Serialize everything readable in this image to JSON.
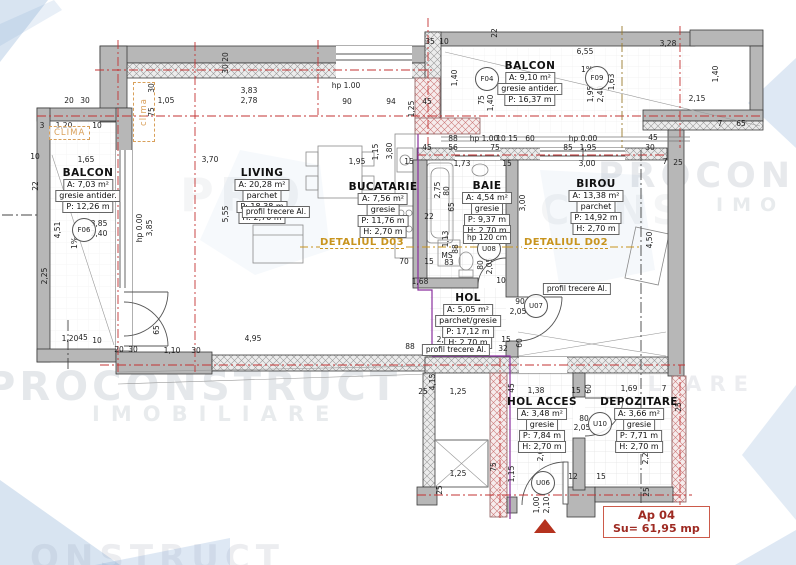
{
  "meta": {
    "apartment": "Ap 04",
    "surface": "Su= 61,95 mp"
  },
  "colors": {
    "axis_red": "#c33333",
    "detail_orange": "#c8941e",
    "boundary_purple": "#8a2f9e",
    "entrance_red": "#b5321e",
    "wall_gray": "#b7b7b7",
    "watermark": "rgba(95,110,130,0.16)"
  },
  "rooms": {
    "balcon_left": {
      "name": "BALCON",
      "area": "A: 7,03 m²",
      "finish": "gresie antider.",
      "perimeter": "P: 12,26 m"
    },
    "balcon_top": {
      "name": "BALCON",
      "area": "A: 9,10 m²",
      "finish": "gresie antider.",
      "perimeter": "P: 16,37 m"
    },
    "living": {
      "name": "LIVING",
      "area": "A: 20,28 m²",
      "finish": "parchet",
      "perimeter": "P: 18,38 m",
      "height": "H: 2,70 m"
    },
    "bucatarie": {
      "name": "BUCATARIE",
      "area": "A: 7,56 m²",
      "finish": "gresie",
      "perimeter": "P: 11,76 m",
      "height": "H: 2,70 m"
    },
    "baie": {
      "name": "BAIE",
      "area": "A: 4,54 m²",
      "finish": "gresie",
      "perimeter": "P: 9,37 m",
      "height": "H: 2,70 m",
      "note": "hp 120 cm"
    },
    "birou": {
      "name": "BIROU",
      "area": "A: 13,38 m²",
      "finish": "parchet",
      "perimeter": "P: 14,92 m",
      "height": "H: 2,70 m"
    },
    "hol": {
      "name": "HOL",
      "area": "A: 5,05 m²",
      "finish": "parchet/gresie",
      "perimeter": "P: 17,12 m",
      "height": "H: 2,70 m"
    },
    "hol_acces": {
      "name": "HOL ACCES",
      "area": "A: 3,48 m²",
      "finish": "gresie",
      "perimeter": "P: 7,84 m",
      "height": "H: 2,70 m"
    },
    "depozitare": {
      "name": "DEPOZITARE",
      "area": "A: 3,66 m²",
      "finish": "gresie",
      "perimeter": "P: 7,71 m",
      "height": "H: 2,70 m"
    }
  },
  "annotations": {
    "profil": "profil trecere Al.",
    "detaliul_d03": "DETALIUL D03",
    "detaliul_d02": "DETALIUL D02",
    "clima_left": "CLIMA",
    "clima_top": "clima"
  },
  "openings": [
    {
      "tag": "F04",
      "x": 487,
      "y": 79
    },
    {
      "tag": "F09",
      "x": 597,
      "y": 78
    },
    {
      "tag": "F06",
      "x": 84,
      "y": 230
    },
    {
      "tag": "U08",
      "x": 489,
      "y": 249
    },
    {
      "tag": "U07",
      "x": 536,
      "y": 306
    },
    {
      "tag": "U10",
      "x": 600,
      "y": 424
    },
    {
      "tag": "U06",
      "x": 543,
      "y": 483
    }
  ],
  "watermarks": [
    {
      "text": "PROCONSTRUCT",
      "x": -14,
      "y": 364,
      "size": 40,
      "ls": 4,
      "o": 0.16
    },
    {
      "text": "IMOBILIARE",
      "x": 92,
      "y": 402,
      "size": 21,
      "ls": 11,
      "o": 0.14
    },
    {
      "text": "PROCONS",
      "x": 598,
      "y": 156,
      "size": 35,
      "ls": 5,
      "o": 0.15
    },
    {
      "text": "IMO",
      "x": 716,
      "y": 194,
      "size": 19,
      "ls": 9,
      "o": 0.14
    },
    {
      "text": "LIARE",
      "x": 648,
      "y": 372,
      "size": 21,
      "ls": 8,
      "o": 0.12
    },
    {
      "text": "ONSTRUCT",
      "x": 30,
      "y": 538,
      "size": 34,
      "ls": 6,
      "o": 0.12
    },
    {
      "text": "PRO",
      "x": 180,
      "y": 168,
      "size": 46,
      "ls": 6,
      "o": 0.07
    },
    {
      "text": "CONS",
      "x": 540,
      "y": 188,
      "size": 40,
      "ls": 5,
      "o": 0.07
    }
  ],
  "dimensions": [
    {
      "t": "20",
      "x": 226,
      "y": 57,
      "v": 1
    },
    {
      "t": "30",
      "x": 226,
      "y": 69,
      "v": 1
    },
    {
      "t": "30",
      "x": 152,
      "y": 88,
      "v": 1
    },
    {
      "t": "75",
      "x": 152,
      "y": 112,
      "v": 1
    },
    {
      "t": "20",
      "x": 69,
      "y": 101
    },
    {
      "t": "30",
      "x": 85,
      "y": 101
    },
    {
      "t": "1,05",
      "x": 166,
      "y": 101
    },
    {
      "t": "3,83",
      "x": 249,
      "y": 91
    },
    {
      "t": "2,78",
      "x": 249,
      "y": 101
    },
    {
      "t": "hp 1.00",
      "x": 346,
      "y": 86
    },
    {
      "t": "90",
      "x": 347,
      "y": 102
    },
    {
      "t": "94",
      "x": 391,
      "y": 102
    },
    {
      "t": "1,25",
      "x": 412,
      "y": 109,
      "v": 1
    },
    {
      "t": "45",
      "x": 427,
      "y": 102
    },
    {
      "t": "35",
      "x": 430,
      "y": 42
    },
    {
      "t": "10",
      "x": 444,
      "y": 42
    },
    {
      "t": "22",
      "x": 495,
      "y": 33,
      "v": 1
    },
    {
      "t": "6,55",
      "x": 585,
      "y": 52
    },
    {
      "t": "3,28",
      "x": 668,
      "y": 44
    },
    {
      "t": "1%",
      "x": 587,
      "y": 70
    },
    {
      "t": "1,63",
      "x": 612,
      "y": 82,
      "v": 1
    },
    {
      "t": "1,95",
      "x": 591,
      "y": 94,
      "v": 1
    },
    {
      "t": "2,40",
      "x": 601,
      "y": 94,
      "v": 1
    },
    {
      "t": "1,40",
      "x": 455,
      "y": 78,
      "v": 1
    },
    {
      "t": "75",
      "x": 482,
      "y": 100,
      "v": 1
    },
    {
      "t": "1,40",
      "x": 491,
      "y": 103,
      "v": 1
    },
    {
      "t": "1,40",
      "x": 716,
      "y": 74,
      "v": 1
    },
    {
      "t": "2,15",
      "x": 697,
      "y": 99
    },
    {
      "t": "7",
      "x": 720,
      "y": 124
    },
    {
      "t": "65",
      "x": 741,
      "y": 124
    },
    {
      "t": "88",
      "x": 453,
      "y": 139
    },
    {
      "t": "hp 1.00",
      "x": 484,
      "y": 139
    },
    {
      "t": "10",
      "x": 501,
      "y": 139
    },
    {
      "t": "15",
      "x": 513,
      "y": 139
    },
    {
      "t": "60",
      "x": 530,
      "y": 139
    },
    {
      "t": "hp 0.00",
      "x": 583,
      "y": 139
    },
    {
      "t": "45",
      "x": 653,
      "y": 138
    },
    {
      "t": "45",
      "x": 427,
      "y": 148
    },
    {
      "t": "56",
      "x": 453,
      "y": 148
    },
    {
      "t": "75",
      "x": 495,
      "y": 148
    },
    {
      "t": "85",
      "x": 568,
      "y": 148
    },
    {
      "t": "1,95",
      "x": 588,
      "y": 148
    },
    {
      "t": "30",
      "x": 650,
      "y": 148
    },
    {
      "t": "3",
      "x": 42,
      "y": 126
    },
    {
      "t": "1,20",
      "x": 64,
      "y": 126
    },
    {
      "t": "10",
      "x": 97,
      "y": 126
    },
    {
      "t": "10",
      "x": 35,
      "y": 157
    },
    {
      "t": "1,65",
      "x": 86,
      "y": 160
    },
    {
      "t": "22",
      "x": 36,
      "y": 186,
      "v": 1
    },
    {
      "t": "3,85",
      "x": 99,
      "y": 224
    },
    {
      "t": "2,40",
      "x": 99,
      "y": 234
    },
    {
      "t": "4,51",
      "x": 58,
      "y": 230,
      "v": 1
    },
    {
      "t": "2,25",
      "x": 45,
      "y": 276,
      "v": 1
    },
    {
      "t": "1%",
      "x": 75,
      "y": 243,
      "v": 1
    },
    {
      "t": "hp 0.00",
      "x": 140,
      "y": 228,
      "v": 1
    },
    {
      "t": "3,85",
      "x": 150,
      "y": 228,
      "v": 1
    },
    {
      "t": "3,70",
      "x": 210,
      "y": 160
    },
    {
      "t": "5,55",
      "x": 226,
      "y": 214,
      "v": 1
    },
    {
      "t": "1,95",
      "x": 357,
      "y": 162
    },
    {
      "t": "15",
      "x": 409,
      "y": 162
    },
    {
      "t": "1,15",
      "x": 376,
      "y": 152,
      "v": 1
    },
    {
      "t": "3,80",
      "x": 390,
      "y": 151,
      "v": 1
    },
    {
      "t": "65",
      "x": 402,
      "y": 197,
      "v": 1
    },
    {
      "t": "22",
      "x": 429,
      "y": 217
    },
    {
      "t": "2,75",
      "x": 438,
      "y": 190,
      "v": 1
    },
    {
      "t": "80",
      "x": 447,
      "y": 191,
      "v": 1
    },
    {
      "t": "65",
      "x": 452,
      "y": 207,
      "v": 1
    },
    {
      "t": "1,13",
      "x": 446,
      "y": 239,
      "v": 1
    },
    {
      "t": "88",
      "x": 456,
      "y": 249,
      "v": 1
    },
    {
      "t": "MS",
      "x": 447,
      "y": 256
    },
    {
      "t": "83",
      "x": 449,
      "y": 263
    },
    {
      "t": "70",
      "x": 404,
      "y": 262
    },
    {
      "t": "15",
      "x": 429,
      "y": 262
    },
    {
      "t": "1,68",
      "x": 420,
      "y": 282
    },
    {
      "t": "1,73",
      "x": 462,
      "y": 164
    },
    {
      "t": "15",
      "x": 507,
      "y": 164
    },
    {
      "t": "3,00",
      "x": 587,
      "y": 164
    },
    {
      "t": "3,00",
      "x": 523,
      "y": 203,
      "v": 1
    },
    {
      "t": "80",
      "x": 481,
      "y": 265,
      "v": 1
    },
    {
      "t": "2,05",
      "x": 490,
      "y": 266,
      "v": 1
    },
    {
      "t": "10",
      "x": 501,
      "y": 281
    },
    {
      "t": "90",
      "x": 520,
      "y": 302
    },
    {
      "t": "2,05",
      "x": 518,
      "y": 312
    },
    {
      "t": "2,43",
      "x": 445,
      "y": 340
    },
    {
      "t": "15",
      "x": 506,
      "y": 340
    },
    {
      "t": "32",
      "x": 503,
      "y": 349
    },
    {
      "t": "88",
      "x": 410,
      "y": 347
    },
    {
      "t": "60",
      "x": 520,
      "y": 343,
      "v": 1
    },
    {
      "t": "4,50",
      "x": 650,
      "y": 240,
      "v": 1
    },
    {
      "t": "7",
      "x": 665,
      "y": 162
    },
    {
      "t": "25",
      "x": 678,
      "y": 163
    },
    {
      "t": "65",
      "x": 157,
      "y": 330,
      "v": 1
    },
    {
      "t": "4,95",
      "x": 253,
      "y": 339
    },
    {
      "t": "1,20",
      "x": 70,
      "y": 339
    },
    {
      "t": "45",
      "x": 83,
      "y": 338
    },
    {
      "t": "10",
      "x": 97,
      "y": 341
    },
    {
      "t": "20",
      "x": 119,
      "y": 350
    },
    {
      "t": "30",
      "x": 133,
      "y": 350
    },
    {
      "t": "1,10",
      "x": 172,
      "y": 351
    },
    {
      "t": "30",
      "x": 196,
      "y": 351
    },
    {
      "t": "4,15",
      "x": 433,
      "y": 382,
      "v": 1
    },
    {
      "t": "25",
      "x": 423,
      "y": 392
    },
    {
      "t": "1,25",
      "x": 458,
      "y": 392
    },
    {
      "t": "45",
      "x": 512,
      "y": 388,
      "v": 1
    },
    {
      "t": "1,38",
      "x": 536,
      "y": 391
    },
    {
      "t": "15",
      "x": 576,
      "y": 391
    },
    {
      "t": "60",
      "x": 589,
      "y": 389,
      "v": 1
    },
    {
      "t": "1,69",
      "x": 629,
      "y": 389
    },
    {
      "t": "7",
      "x": 664,
      "y": 389
    },
    {
      "t": "25",
      "x": 679,
      "y": 407,
      "v": 1
    },
    {
      "t": "80",
      "x": 584,
      "y": 419
    },
    {
      "t": "2,05",
      "x": 582,
      "y": 428
    },
    {
      "t": "1,25",
      "x": 458,
      "y": 474
    },
    {
      "t": "75",
      "x": 494,
      "y": 467,
      "v": 1
    },
    {
      "t": "1,15",
      "x": 512,
      "y": 474,
      "v": 1
    },
    {
      "t": "25",
      "x": 440,
      "y": 490,
      "v": 1
    },
    {
      "t": "2,60",
      "x": 541,
      "y": 453,
      "v": 1
    },
    {
      "t": "2,20",
      "x": 646,
      "y": 456,
      "v": 1
    },
    {
      "t": "12",
      "x": 573,
      "y": 477
    },
    {
      "t": "15",
      "x": 601,
      "y": 477
    },
    {
      "t": "1,00",
      "x": 537,
      "y": 505,
      "v": 1
    },
    {
      "t": "2,10",
      "x": 547,
      "y": 505,
      "v": 1
    },
    {
      "t": "25",
      "x": 647,
      "y": 492,
      "v": 1
    }
  ]
}
